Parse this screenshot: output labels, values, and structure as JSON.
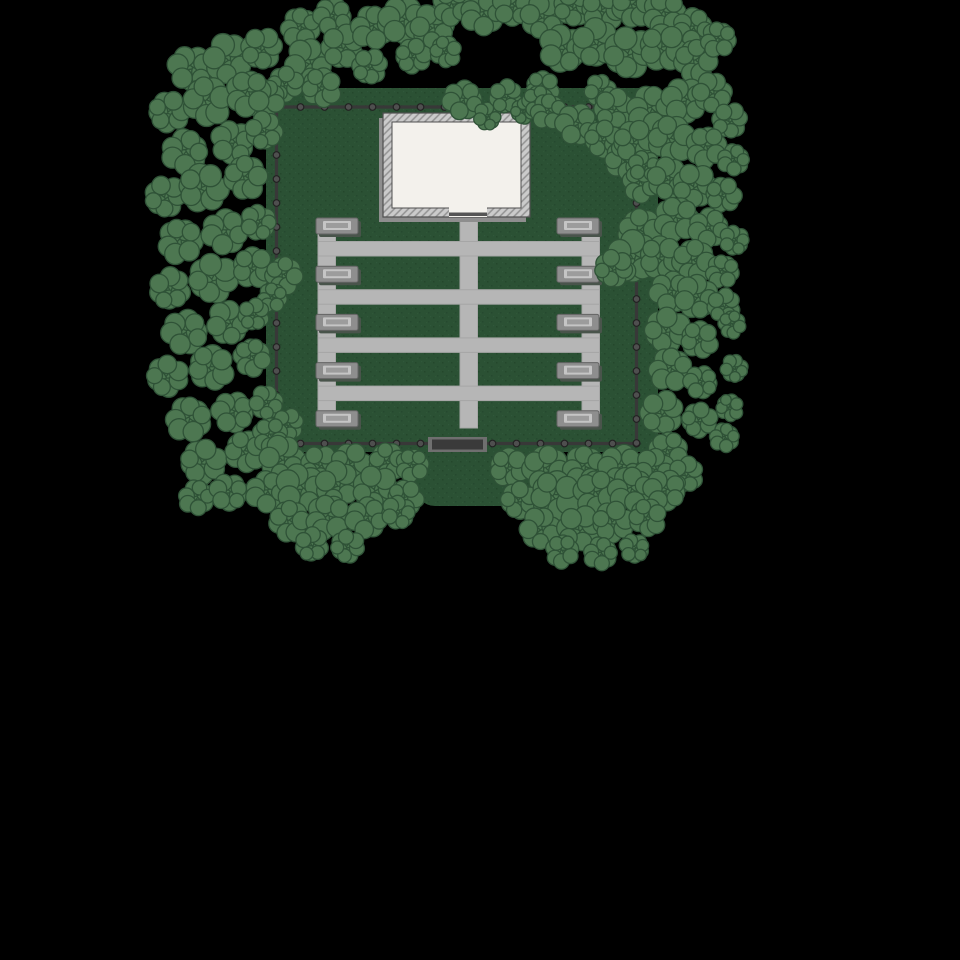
{
  "canvas": {
    "w": 960,
    "h": 960,
    "bg": "#000000"
  },
  "palette": {
    "ground": "#2b5134",
    "ground_speck_dark": "#1f3d27",
    "ground_speck_light": "#356140",
    "tree_fill": "#4d7751",
    "tree_stroke": "#2f5237",
    "path_fill": "#b6b6b6",
    "path_stroke": "#a6a6a6",
    "fence_rail": "#383838",
    "fence_post_fill": "#4f4f4f",
    "fence_post_stroke": "#222222",
    "gate_frame": "#6f6f6f",
    "gate_fill": "#3a3a3a",
    "bench_outer": "#8e8e8e",
    "bench_edge": "#646464",
    "bench_light": "#c5c5c5",
    "bench_mid": "#9c9c9c",
    "bench_shadow": "#49544b",
    "bldg_wall": "#cbcbcb",
    "bldg_hatch": "#929292",
    "bldg_outline": "#4f4f4f",
    "bldg_floor": "#f3f1ec",
    "bldg_shadow": "#8e8e8e",
    "bldg_threshold": "#555555"
  },
  "ground": {
    "main": {
      "x": 266,
      "y": 88,
      "w": 392,
      "h": 364,
      "r": 14
    },
    "apron": {
      "x": 415,
      "y": 440,
      "w": 150,
      "h": 66,
      "r": 20
    }
  },
  "fence": {
    "left": 276.5,
    "right": 636.5,
    "top": 107,
    "bottom": 443.5,
    "rail_w": 3.2,
    "post_r": 3.3,
    "post_spacing": 24,
    "gate": {
      "x": 428,
      "y": 437,
      "w": 59,
      "h": 15,
      "inner_inset_x": 4,
      "inner_inset_y": 2.5
    }
  },
  "paths": {
    "verticals": [
      {
        "x": 318,
        "y": 224,
        "w": 17.5,
        "h": 200
      },
      {
        "x": 460,
        "y": 214,
        "w": 17.5,
        "h": 214
      },
      {
        "x": 582,
        "y": 224,
        "w": 17.5,
        "h": 200
      }
    ],
    "horizontals": [
      {
        "x": 318,
        "y": 241.5,
        "w": 281.5,
        "h": 14.5
      },
      {
        "x": 318,
        "y": 289.7,
        "w": 281.5,
        "h": 14.5
      },
      {
        "x": 318,
        "y": 337.9,
        "w": 281.5,
        "h": 14.5
      },
      {
        "x": 318,
        "y": 386.1,
        "w": 281.5,
        "h": 14.5
      }
    ]
  },
  "building": {
    "x": 383,
    "y": 113,
    "w": 147,
    "h": 104,
    "wall": 9,
    "door": {
      "x": 449,
      "w": 38,
      "threshold_h": 3.5
    },
    "shadow_dx": -4,
    "shadow_dy": 5
  },
  "benches": {
    "w": 42,
    "h": 16,
    "cols_x": [
      316,
      557
    ],
    "rows_y": [
      218,
      266.2,
      314.4,
      362.6,
      410.8
    ],
    "light": {
      "dx": 7,
      "dy": 3,
      "w": 28,
      "h": 9
    },
    "mid": {
      "dx": 10,
      "dy": 5,
      "w": 22,
      "h": 5
    },
    "shadow_dx": 3,
    "shadow_dy": 3
  },
  "trees": {
    "stroke_w": 1.3,
    "satellites": [
      [
        0,
        0,
        0.72
      ],
      [
        0.52,
        0.12,
        0.48
      ],
      [
        0.36,
        -0.42,
        0.45
      ],
      [
        -0.28,
        -0.48,
        0.46
      ],
      [
        -0.54,
        0.04,
        0.44
      ],
      [
        -0.34,
        0.44,
        0.46
      ],
      [
        0.28,
        0.48,
        0.44
      ],
      [
        0.02,
        -0.6,
        0.4
      ],
      [
        0.58,
        -0.28,
        0.38
      ]
    ],
    "clumps": [
      [
        300,
        28,
        20
      ],
      [
        332,
        16,
        19
      ],
      [
        308,
        62,
        24
      ],
      [
        343,
        46,
        22
      ],
      [
        286,
        84,
        18
      ],
      [
        322,
        88,
        20
      ],
      [
        265,
        100,
        20
      ],
      [
        372,
        28,
        22
      ],
      [
        402,
        20,
        24
      ],
      [
        432,
        26,
        22
      ],
      [
        370,
        66,
        18
      ],
      [
        414,
        56,
        18
      ],
      [
        446,
        52,
        16
      ],
      [
        452,
        6,
        20
      ],
      [
        482,
        14,
        22
      ],
      [
        512,
        6,
        20
      ],
      [
        542,
        16,
        22
      ],
      [
        574,
        6,
        20
      ],
      [
        604,
        10,
        22
      ],
      [
        634,
        6,
        22
      ],
      [
        664,
        14,
        22
      ],
      [
        692,
        28,
        20
      ],
      [
        562,
        48,
        24
      ],
      [
        596,
        42,
        24
      ],
      [
        630,
        52,
        26
      ],
      [
        664,
        48,
        24
      ],
      [
        696,
        62,
        22
      ],
      [
        718,
        40,
        18
      ],
      [
        462,
        100,
        20
      ],
      [
        487,
        116,
        14
      ],
      [
        506,
        96,
        17
      ],
      [
        524,
        111,
        13
      ],
      [
        543,
        88,
        17
      ],
      [
        538,
        102,
        16
      ],
      [
        548,
        112,
        18
      ],
      [
        576,
        124,
        21
      ],
      [
        600,
        90,
        16
      ],
      [
        614,
        108,
        20
      ],
      [
        604,
        139,
        19
      ],
      [
        626,
        160,
        21
      ],
      [
        641,
        184,
        19
      ],
      [
        650,
        110,
        24
      ],
      [
        684,
        100,
        23
      ],
      [
        712,
        92,
        20
      ],
      [
        730,
        120,
        18
      ],
      [
        636,
        142,
        22
      ],
      [
        672,
        140,
        24
      ],
      [
        706,
        148,
        21
      ],
      [
        733,
        160,
        16
      ],
      [
        644,
        166,
        16
      ],
      [
        668,
        178,
        21
      ],
      [
        695,
        185,
        22
      ],
      [
        724,
        195,
        18
      ],
      [
        641,
        232,
        23
      ],
      [
        676,
        220,
        23
      ],
      [
        708,
        228,
        20
      ],
      [
        734,
        240,
        15
      ],
      [
        633,
        256,
        26
      ],
      [
        614,
        268,
        19
      ],
      [
        662,
        258,
        22
      ],
      [
        694,
        262,
        22
      ],
      [
        722,
        272,
        17
      ],
      [
        670,
        292,
        21
      ],
      [
        696,
        296,
        22
      ],
      [
        724,
        305,
        17
      ],
      [
        668,
        330,
        23
      ],
      [
        700,
        340,
        19
      ],
      [
        732,
        325,
        14
      ],
      [
        670,
        370,
        22
      ],
      [
        700,
        382,
        17
      ],
      [
        734,
        368,
        14
      ],
      [
        662,
        412,
        22
      ],
      [
        700,
        420,
        18
      ],
      [
        730,
        408,
        14
      ],
      [
        668,
        452,
        20
      ],
      [
        724,
        438,
        15
      ],
      [
        190,
        68,
        23
      ],
      [
        228,
        58,
        25
      ],
      [
        262,
        48,
        21
      ],
      [
        170,
        112,
        21
      ],
      [
        208,
        102,
        25
      ],
      [
        248,
        94,
        23
      ],
      [
        184,
        152,
        23
      ],
      [
        232,
        142,
        22
      ],
      [
        264,
        130,
        19
      ],
      [
        166,
        196,
        21
      ],
      [
        204,
        188,
        25
      ],
      [
        246,
        178,
        22
      ],
      [
        180,
        242,
        23
      ],
      [
        224,
        232,
        23
      ],
      [
        258,
        222,
        18
      ],
      [
        170,
        288,
        21
      ],
      [
        214,
        278,
        25
      ],
      [
        254,
        268,
        21
      ],
      [
        284,
        276,
        19
      ],
      [
        272,
        298,
        15
      ],
      [
        184,
        332,
        23
      ],
      [
        228,
        322,
        22
      ],
      [
        254,
        314,
        16
      ],
      [
        168,
        376,
        21
      ],
      [
        212,
        368,
        23
      ],
      [
        252,
        358,
        19
      ],
      [
        188,
        420,
        23
      ],
      [
        232,
        412,
        21
      ],
      [
        266,
        402,
        17
      ],
      [
        288,
        424,
        16
      ],
      [
        204,
        462,
        23
      ],
      [
        246,
        452,
        21
      ],
      [
        270,
        436,
        18
      ],
      [
        196,
        498,
        18
      ],
      [
        228,
        492,
        19
      ],
      [
        282,
        458,
        23
      ],
      [
        320,
        464,
        19
      ],
      [
        352,
        464,
        21
      ],
      [
        388,
        462,
        19
      ],
      [
        412,
        466,
        17
      ],
      [
        266,
        492,
        21
      ],
      [
        300,
        488,
        25
      ],
      [
        338,
        484,
        23
      ],
      [
        376,
        488,
        23
      ],
      [
        406,
        498,
        18
      ],
      [
        290,
        522,
        21
      ],
      [
        328,
        518,
        23
      ],
      [
        366,
        518,
        21
      ],
      [
        398,
        512,
        17
      ],
      [
        312,
        544,
        17
      ],
      [
        348,
        546,
        17
      ],
      [
        510,
        468,
        20
      ],
      [
        546,
        470,
        24
      ],
      [
        584,
        468,
        22
      ],
      [
        620,
        466,
        22
      ],
      [
        654,
        468,
        20
      ],
      [
        686,
        474,
        18
      ],
      [
        520,
        500,
        19
      ],
      [
        556,
        496,
        25
      ],
      [
        596,
        494,
        23
      ],
      [
        630,
        490,
        23
      ],
      [
        664,
        490,
        21
      ],
      [
        540,
        528,
        21
      ],
      [
        580,
        528,
        23
      ],
      [
        614,
        522,
        21
      ],
      [
        648,
        518,
        19
      ],
      [
        562,
        552,
        17
      ],
      [
        600,
        554,
        17
      ],
      [
        634,
        548,
        15
      ]
    ]
  }
}
